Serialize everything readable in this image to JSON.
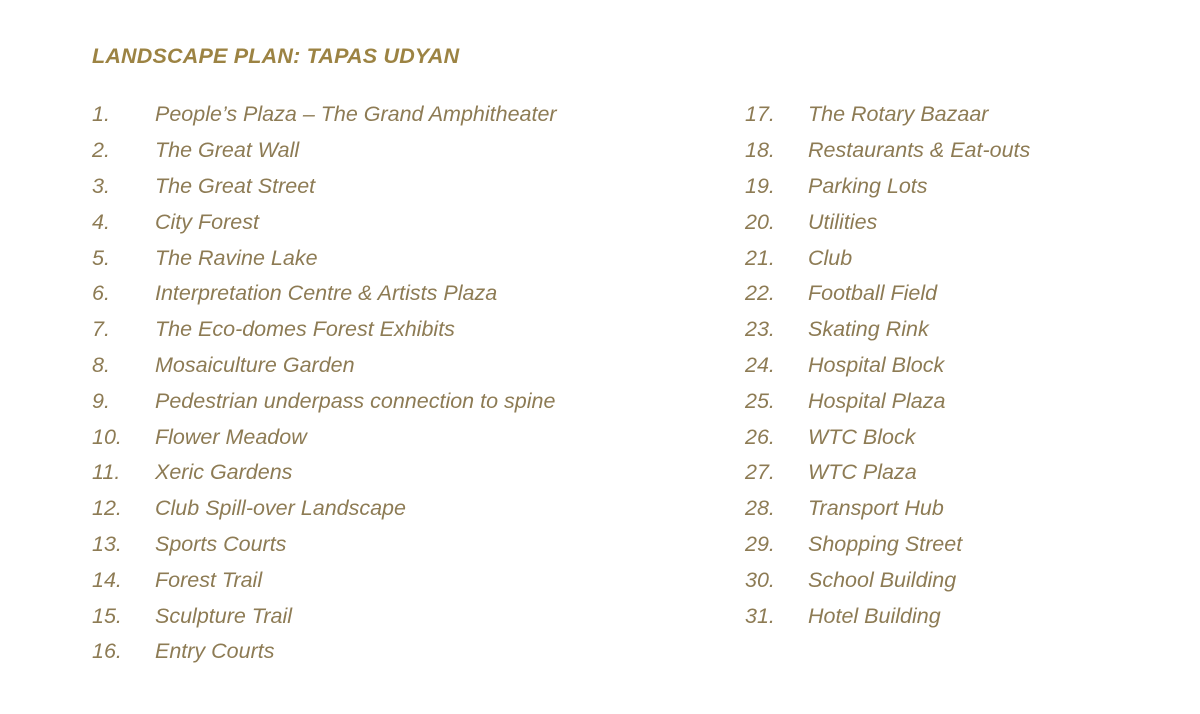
{
  "title": "LANDSCAPE PLAN: TAPAS UDYAN",
  "colors": {
    "background": "#ffffff",
    "title_text": "#9c8343",
    "item_text": "#8d7b54"
  },
  "items": [
    {
      "num": "1.",
      "name": "People’s Plaza – The Grand Amphitheater"
    },
    {
      "num": "2.",
      "name": "The Great Wall"
    },
    {
      "num": "3.",
      "name": "The Great Street"
    },
    {
      "num": "4.",
      "name": "City Forest"
    },
    {
      "num": "5.",
      "name": "The Ravine Lake"
    },
    {
      "num": "6.",
      "name": "Interpretation Centre & Artists Plaza"
    },
    {
      "num": "7.",
      "name": "The Eco-domes Forest Exhibits"
    },
    {
      "num": "8.",
      "name": "Mosaiculture Garden"
    },
    {
      "num": "9.",
      "name": "Pedestrian underpass connection to spine"
    },
    {
      "num": "10.",
      "name": "Flower Meadow"
    },
    {
      "num": "11.",
      "name": "Xeric Gardens"
    },
    {
      "num": "12.",
      "name": "Club Spill-over Landscape"
    },
    {
      "num": "13.",
      "name": "Sports Courts"
    },
    {
      "num": "14.",
      "name": "Forest Trail"
    },
    {
      "num": "15.",
      "name": "Sculpture Trail"
    },
    {
      "num": "16.",
      "name": "Entry Courts"
    },
    {
      "num": "17.",
      "name": "The Rotary Bazaar"
    },
    {
      "num": "18.",
      "name": "Restaurants & Eat-outs"
    },
    {
      "num": "19.",
      "name": "Parking Lots"
    },
    {
      "num": "20.",
      "name": "Utilities"
    },
    {
      "num": "21.",
      "name": "Club"
    },
    {
      "num": "22.",
      "name": "Football Field"
    },
    {
      "num": "23.",
      "name": "Skating Rink"
    },
    {
      "num": "24.",
      "name": "Hospital Block"
    },
    {
      "num": "25.",
      "name": "Hospital Plaza"
    },
    {
      "num": "26.",
      "name": "WTC Block"
    },
    {
      "num": "27.",
      "name": "WTC Plaza"
    },
    {
      "num": "28.",
      "name": "Transport Hub"
    },
    {
      "num": "29.",
      "name": "Shopping Street"
    },
    {
      "num": "30.",
      "name": "School Building"
    },
    {
      "num": "31.",
      "name": "Hotel Building"
    }
  ]
}
